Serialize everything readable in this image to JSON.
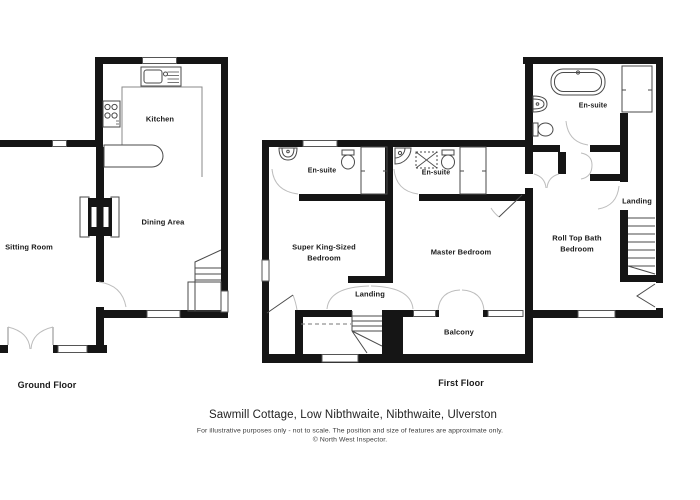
{
  "meta": {
    "document_type": "estate-agent floor plan",
    "background": "#ffffff"
  },
  "colors": {
    "wall": "#151515",
    "fixture_outline": "#4a4a4a",
    "door_arc": "#bdbdbd",
    "window_border": "#555555",
    "counter_line": "#8a8a8a"
  },
  "footer": {
    "title": "Sawmill Cottage, Low Nibthwaite, Nibthwaite, Ulverston",
    "disclaimer": "For illustrative purposes only - not to scale. The position and size of features are approximate only.",
    "copyright": "© North West Inspector."
  },
  "floors": {
    "ground": {
      "label": "Ground Floor",
      "rooms": {
        "kitchen": {
          "name": "Kitchen"
        },
        "dining": {
          "name": "Dining Area"
        },
        "sitting": {
          "name": "Sitting Room"
        }
      }
    },
    "first": {
      "label": "First Floor",
      "rooms": {
        "ensuite_left": {
          "name": "En-suite"
        },
        "ensuite_master": {
          "name": "En-suite"
        },
        "ensuite_rolltop": {
          "name": "En-suite"
        },
        "super_king": {
          "lines": [
            "Super King-Sized",
            "Bedroom"
          ]
        },
        "master": {
          "name": "Master Bedroom"
        },
        "rolltop": {
          "lines": [
            "Roll Top Bath",
            "Bedroom"
          ]
        },
        "landing_main": {
          "name": "Landing"
        },
        "landing_rolltop": {
          "name": "Landing"
        },
        "balcony": {
          "name": "Balcony"
        }
      }
    }
  }
}
